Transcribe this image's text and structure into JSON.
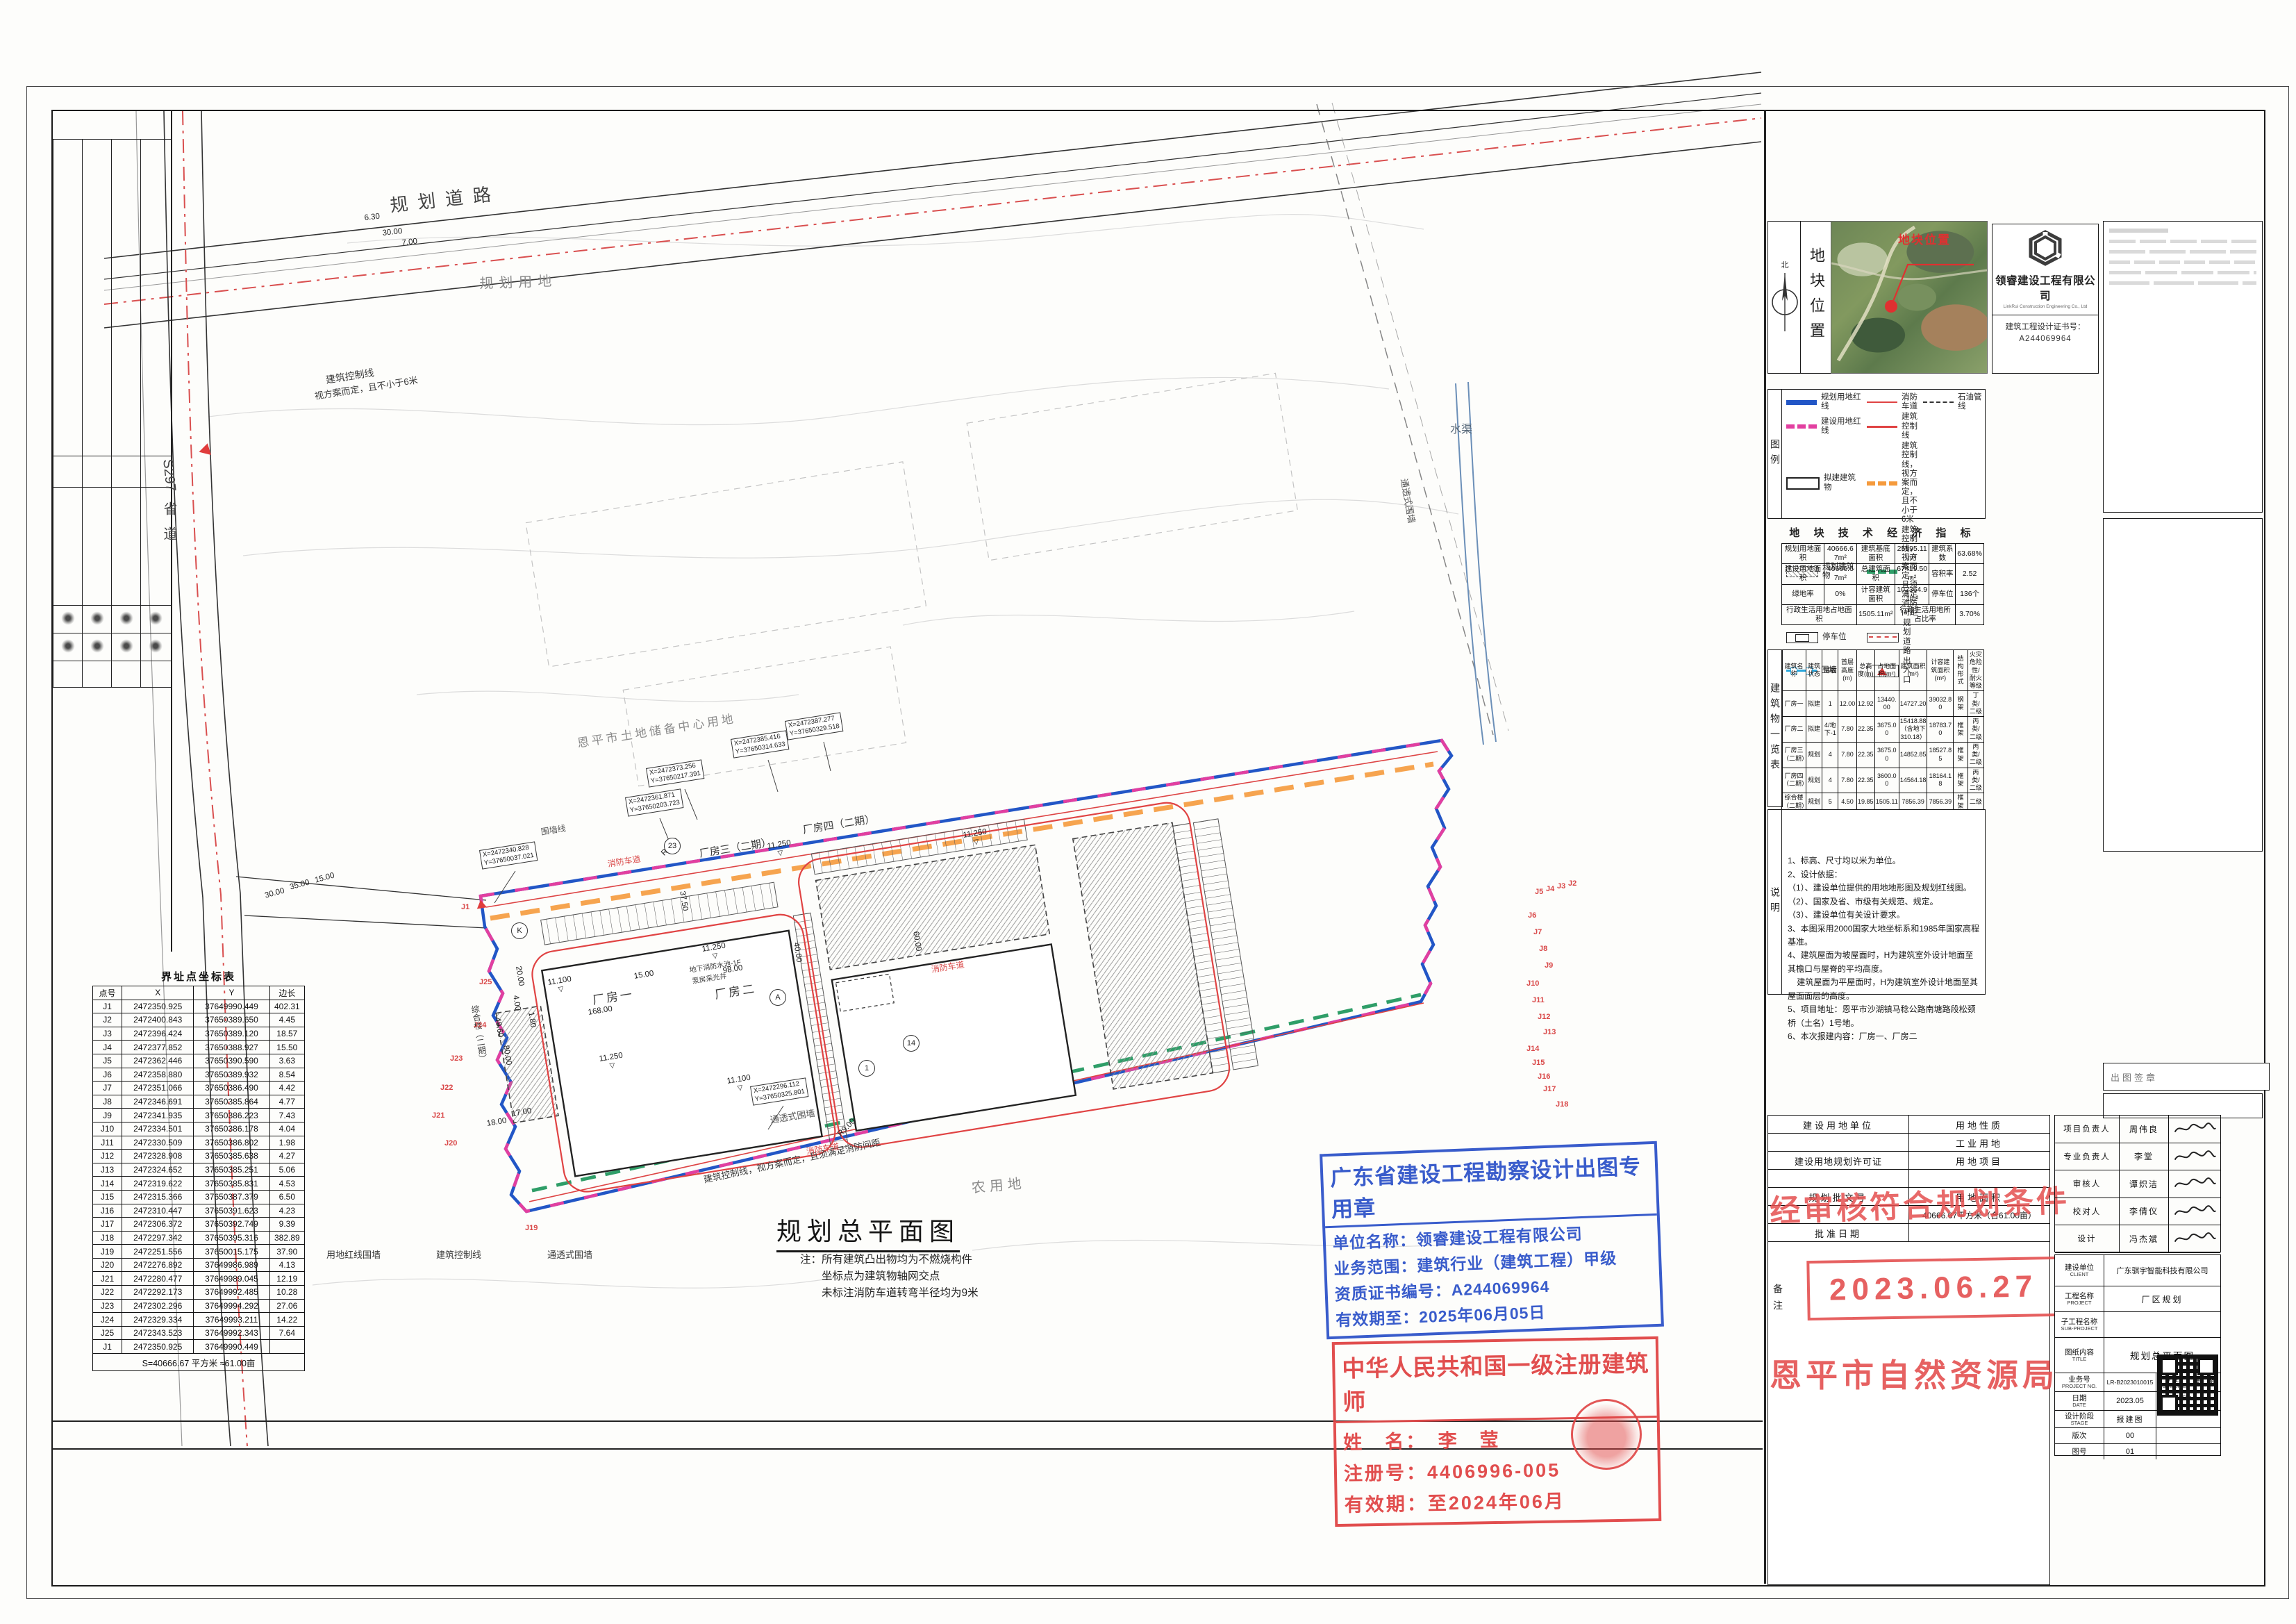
{
  "plan": {
    "title": "规划总平面图",
    "title_notes": [
      "注：所有建筑凸出物均为不燃烧构件",
      "坐标点为建筑物轴网交点",
      "未标注消防车道转弯半径均为9米"
    ],
    "labels": {
      "road_top": "规划道路",
      "land_plan": "规划用地",
      "land_reserve": "恩平市土地储备中心用地",
      "land_agri": "农用地",
      "channel": "水渠",
      "s297": "S297",
      "provincial": "省道",
      "fence_trans": "通透式围墙",
      "fence_line": "围墙线",
      "ctrl": "建筑控制线",
      "ctrl_note6": "视方案而定，且不小于6米",
      "ctrl_fire": "建筑控制线，视方案而定，且须满足消防间距",
      "redline_fence": "用地红线围墙",
      "fire_lane": "消防车道",
      "pool": "地下消防水池-1F",
      "pump": "泵房采光井",
      "b1": "厂房一",
      "b2": "厂房二",
      "b3": "厂房三（二期）",
      "b4": "厂房四（二期）",
      "b5": "综合楼（二期）",
      "elev": "▽"
    },
    "dims": {
      "d168": "168.00",
      "d98": "98.00",
      "d375": "37.50",
      "d40": "40.00",
      "d60": "60.00",
      "d80": "80.00",
      "d496": "49.60",
      "d20": "20.00",
      "d15": "15.00",
      "d18": "18.00",
      "d17": "17.00",
      "d11250": "11.250",
      "d11100": "11.100",
      "d35": "35.00",
      "d30": "30.00",
      "d630": "6.30",
      "d700": "7.00",
      "r9": "R9.00",
      "d400": "4.00",
      "d180": "1.80"
    },
    "coords": [
      [
        "X=2472340.828",
        "Y=37650037.021"
      ],
      [
        "X=2472361.871",
        "Y=37650203.723"
      ],
      [
        "X=2472373.256",
        "Y=37650217.391"
      ],
      [
        "X=2472385.416",
        "Y=37650314.633"
      ],
      [
        "X=2472387.277",
        "Y=37650329.518"
      ],
      [
        "X=2472296.112",
        "Y=37650325.801"
      ]
    ],
    "jpoints": [
      "J1",
      "J2",
      "J3",
      "J4",
      "J5",
      "J6",
      "J7",
      "J8",
      "J9",
      "J10",
      "J11",
      "J12",
      "J13",
      "J14",
      "J15",
      "J16",
      "J17",
      "J18",
      "J19",
      "J20",
      "J21",
      "J22",
      "J23",
      "J24",
      "J25"
    ],
    "bubbles": [
      "K",
      "A",
      "1",
      "14",
      "23"
    ]
  },
  "coord_table": {
    "title": "界址点坐标表",
    "headers": [
      "点号",
      "X",
      "Y",
      "边长"
    ],
    "rows": [
      [
        "J1",
        "2472350.925",
        "37649990.449",
        "402.31"
      ],
      [
        "J2",
        "2472400.843",
        "37650389.650",
        "4.45"
      ],
      [
        "J3",
        "2472396.424",
        "37650389.120",
        "18.57"
      ],
      [
        "J4",
        "2472377.852",
        "37650388.927",
        "15.50"
      ],
      [
        "J5",
        "2472362.446",
        "37650390.590",
        "3.63"
      ],
      [
        "J6",
        "2472358.880",
        "37650389.932",
        "8.54"
      ],
      [
        "J7",
        "2472351.066",
        "37650386.490",
        "4.42"
      ],
      [
        "J8",
        "2472346.691",
        "37650385.864",
        "4.77"
      ],
      [
        "J9",
        "2472341.935",
        "37650386.223",
        "7.43"
      ],
      [
        "J10",
        "2472334.501",
        "37650386.178",
        "4.04"
      ],
      [
        "J11",
        "2472330.509",
        "37650386.802",
        "1.98"
      ],
      [
        "J12",
        "2472328.908",
        "37650385.638",
        "4.27"
      ],
      [
        "J13",
        "2472324.652",
        "37650385.251",
        "5.06"
      ],
      [
        "J14",
        "2472319.622",
        "37650385.831",
        "4.53"
      ],
      [
        "J15",
        "2472315.366",
        "37650387.379",
        "6.50"
      ],
      [
        "J16",
        "2472310.447",
        "37650391.623",
        "4.23"
      ],
      [
        "J17",
        "2472306.372",
        "37650392.749",
        "9.39"
      ],
      [
        "J18",
        "2472297.342",
        "37650395.316",
        "382.89"
      ],
      [
        "J19",
        "2472251.556",
        "37650015.175",
        "37.90"
      ],
      [
        "J20",
        "2472276.892",
        "37649986.989",
        "4.13"
      ],
      [
        "J21",
        "2472280.477",
        "37649989.045",
        "12.19"
      ],
      [
        "J22",
        "2472292.173",
        "37649992.485",
        "10.28"
      ],
      [
        "J23",
        "2472302.296",
        "37649994.292",
        "27.06"
      ],
      [
        "J24",
        "2472329.334",
        "37649993.211",
        "14.22"
      ],
      [
        "J25",
        "2472343.523",
        "37649992.343",
        "7.64"
      ],
      [
        "J1",
        "2472350.925",
        "37649990.449",
        ""
      ]
    ],
    "total": "S=40666.67 平方米 ≈61.00亩"
  },
  "location": {
    "north_label": "北",
    "panel_label": "地块位置",
    "map_marker_label": "地块位置"
  },
  "company": {
    "name": "领睿建设工程有限公司",
    "name_en": "LinkRui Construction Engineering Co., Ltd",
    "cert_label": "建筑工程设计证书号：",
    "cert_no": "A244069964"
  },
  "legend": {
    "strip": "图例",
    "items": [
      {
        "c": "sw-blue",
        "t": "规划用地红线"
      },
      {
        "c": "sw-pink",
        "t": "建设用地红线"
      },
      {
        "c": "sw-rect",
        "t": "拟建建筑物"
      },
      {
        "c": "sw-hatch",
        "t": "规划建筑物"
      },
      {
        "c": "sw-park",
        "t": "停车位"
      },
      {
        "c": "sw-fence",
        "t": "围墙"
      },
      {
        "c": "sw-redthin",
        "t": "消防车道"
      },
      {
        "c": "sw-red",
        "t": "建筑控制线"
      },
      {
        "c": "sw-orange",
        "t": "建筑控制线，视方案而定，且不小于6米"
      },
      {
        "c": "sw-green",
        "t": "建筑控制线，视方案而定，且须满足消防间距"
      },
      {
        "c": "sw-road",
        "t": "规划道路"
      },
      {
        "c": "sw-tri",
        "t": "出入口"
      },
      {
        "c": "sw-blackdash",
        "t": "石油管线"
      }
    ]
  },
  "indicators": {
    "title": "地 块 技 术 经 济 指 标",
    "cells": [
      [
        "规划用地面积",
        "40666.67m²",
        "建筑基底面积",
        "25895.11m²",
        "建筑系数",
        "63.68%"
      ],
      [
        "建设用地面积",
        "40666.67m²",
        "总建筑面积",
        "67419.50m²",
        "容积率",
        "2.52"
      ],
      [
        "绿地率",
        "0%",
        "计容建筑面积",
        "102364.91m²",
        "停车位",
        "136个"
      ]
    ],
    "row4": [
      "行政生活用地占地面积",
      "1505.11m²",
      "行政生活用地所占比率",
      "3.70%"
    ]
  },
  "buildings": {
    "strip": "建筑物一览表",
    "headers": [
      "建筑名称",
      "建筑状态",
      "层数",
      "首层高度(m)",
      "总高度(m)",
      "占地面积(m²)",
      "建筑面积(m²)",
      "计容建筑面积(m²)",
      "结构形式",
      "火灾危险性/耐火等级"
    ],
    "rows": [
      [
        "厂房一",
        "拟建",
        "1",
        "12.00",
        "12.92",
        "13440.00",
        "14727.20",
        "39032.80",
        "钢架",
        "丁类/二级"
      ],
      [
        "厂房二",
        "拟建",
        "4/地下-1",
        "7.80",
        "22.35",
        "3675.00",
        "15418.88（含地下310.18）",
        "18783.70",
        "框架",
        "丙类/二级"
      ],
      [
        "厂房三（二期）",
        "规划",
        "4",
        "7.80",
        "22.35",
        "3675.00",
        "14852.85",
        "18527.85",
        "框架",
        "丙类/二级"
      ],
      [
        "厂房四（二期）",
        "规划",
        "4",
        "7.80",
        "22.35",
        "3600.00",
        "14564.18",
        "18164.18",
        "框架",
        "丙类/二级"
      ],
      [
        "综合楼（二期）",
        "规划",
        "5",
        "4.50",
        "19.85",
        "1505.11",
        "7856.39",
        "7856.39",
        "框架",
        "二级"
      ],
      [
        "合计",
        "",
        "",
        "",
        "",
        "25895.11",
        "67419.50",
        "102364.91",
        "",
        ""
      ]
    ]
  },
  "notes": {
    "strip": "说明",
    "lines": [
      "1、标高、尺寸均以米为单位。",
      "2、设计依据：",
      "（1）、建设单位提供的用地地形图及规划红线图。",
      "（2）、国家及省、市级有关规范、规定。",
      "（3）、建设单位有关设计要求。",
      "3、本图采用2000国家大地坐标系和1985年国家高程基准。",
      "4、建筑屋面为坡屋面时，H为建筑室外设计地面至其檐口与屋脊的平均高度。",
      "    建筑屋面为平屋面时，H为建筑室外设计地面至其屋面面层的高度。",
      "5、项目地址：恩平市沙湖镇马稔公路南塘路段松颈桥（土名）1号地。",
      "6、本次报建内容：厂房一、厂房二"
    ]
  },
  "sign_box": {
    "label": "出图签章"
  },
  "landuse": {
    "unit_label": "建设用地单位",
    "nature_label": "用地性质",
    "nature_value": "工业用地",
    "permit_label": "建设用地规划许可证",
    "project_label": "用地项目",
    "doc_label": "规划批文号",
    "area_label": "用地面积",
    "area_value": "40666.67平方米（合61.00亩）",
    "date_label": "批准日期",
    "remark_label": "备注"
  },
  "stamps": {
    "approval_text": "经审核符合规划条件",
    "approval_date": "2023.06.27",
    "bureau": "恩平市自然资源局",
    "blue": {
      "title": "广东省建设工程勘察设计出图专用章",
      "line1": "单位名称：领睿建设工程有限公司",
      "line2": "业务范围：建筑行业（建筑工程）甲级",
      "line3": "资质证书编号：A244069964",
      "line4": "有效期至：2025年06月05日"
    },
    "arch": {
      "title": "中华人民共和国一级注册建筑师",
      "name_line": "姓　名：　李　莹",
      "reg_line": "注册号：4406996-005",
      "valid_line": "有效期：至2024年06月"
    }
  },
  "titleblock": {
    "personnel": [
      {
        "label": "项目负责人",
        "name": "周伟良"
      },
      {
        "label": "专业负责人",
        "name": "李堂"
      },
      {
        "label": "审核人",
        "name": "谭炽洁"
      },
      {
        "label": "校对人",
        "name": "李倩仪"
      },
      {
        "label": "设计",
        "name": "冯杰斌"
      }
    ],
    "client_label": "建设单位",
    "client_en": "CLIENT",
    "client": "广东骐宇智能科技有限公司",
    "project_label": "工程名称",
    "project_en": "PROJECT",
    "project": "厂区规划",
    "sub_label": "子工程名称",
    "sub_en": "SUB-PROJECT",
    "sub": "",
    "title_label": "图纸内容",
    "title_en": "TITLE",
    "title": "规划总平面图",
    "projno_label": "业务号",
    "projno_en": "PROJECT NO.",
    "projno": "LR-B2023010015",
    "discipline_label": "专业",
    "discipline_en": "DISCIPLINE",
    "discipline": "建　筑",
    "date_label": "日期",
    "date_en": "DATE",
    "date": "2023.05",
    "qr_label": "归档二维码：",
    "stage_label": "设计阶段",
    "stage_en": "STAGE",
    "stage": "报建图",
    "rev_label": "版次",
    "rev": "00",
    "no_label": "图号",
    "no": "01"
  }
}
